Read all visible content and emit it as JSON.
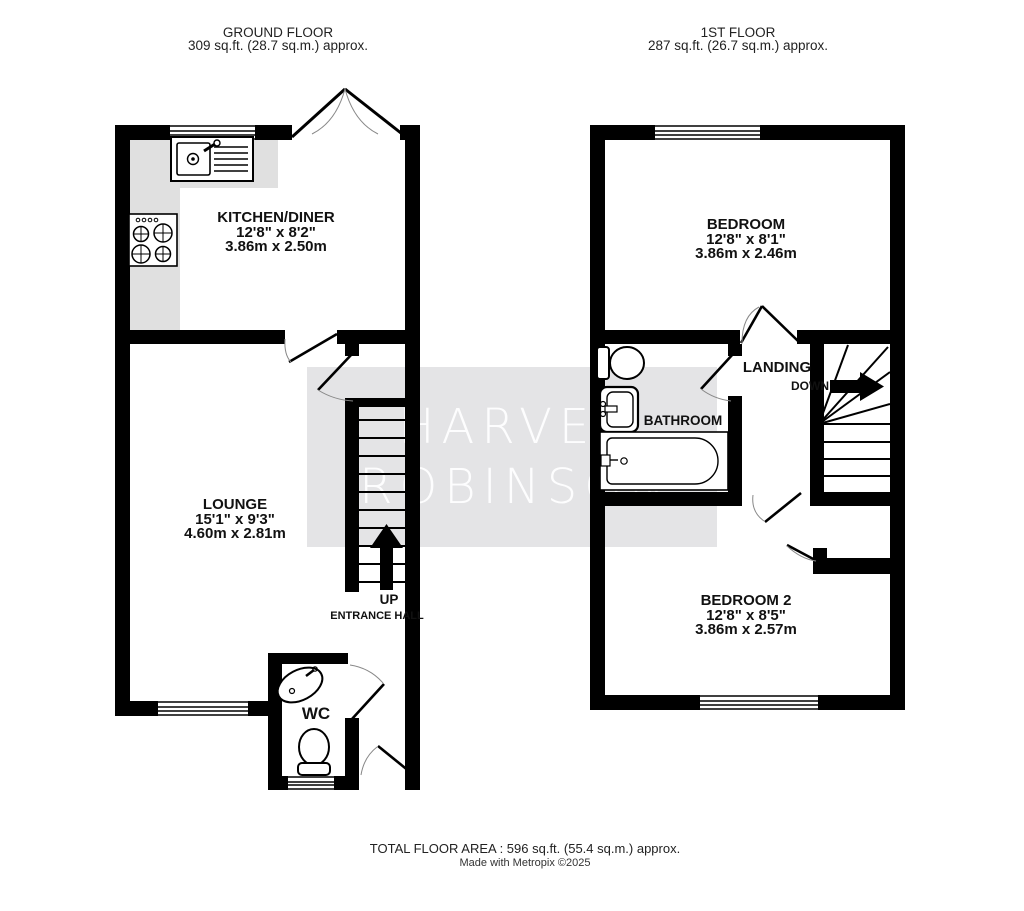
{
  "floors": [
    {
      "title": "GROUND FLOOR",
      "subtitle": "309 sq.ft. (28.7 sq.m.) approx."
    },
    {
      "title": "1ST FLOOR",
      "subtitle": "287 sq.ft. (26.7 sq.m.) approx."
    }
  ],
  "rooms": {
    "kitchen": {
      "name": "KITCHEN/DINER",
      "imperial": "12'8\"  x 8'2\"",
      "metric": "3.86m  x 2.50m"
    },
    "lounge": {
      "name": "LOUNGE",
      "imperial": "15'1\"  x 9'3\"",
      "metric": "4.60m  x 2.81m"
    },
    "wc": {
      "name": "WC"
    },
    "bedroom": {
      "name": "BEDROOM",
      "imperial": "12'8\"  x 8'1\"",
      "metric": "3.86m  x 2.46m"
    },
    "bedroom2": {
      "name": "BEDROOM 2",
      "imperial": "12'8\"  x 8'5\"",
      "metric": "3.86m  x 2.57m"
    },
    "landing": {
      "name": "LANDING"
    },
    "bathroom": {
      "name": "BATHROOM"
    }
  },
  "annotations": {
    "up": "UP",
    "down": "DOWN",
    "entrance_hall": "ENTRANCE HALL"
  },
  "watermark": {
    "line1": "HARVEY",
    "line2": "ROBINSON",
    "band_color": "#e4e4e6"
  },
  "footer": {
    "total_area": "TOTAL FLOOR AREA : 596 sq.ft. (55.4 sq.m.) approx.",
    "credit": "Made with Metropix ©2025"
  },
  "colors": {
    "wall": "#000000",
    "counter": "#e0e0e0"
  }
}
